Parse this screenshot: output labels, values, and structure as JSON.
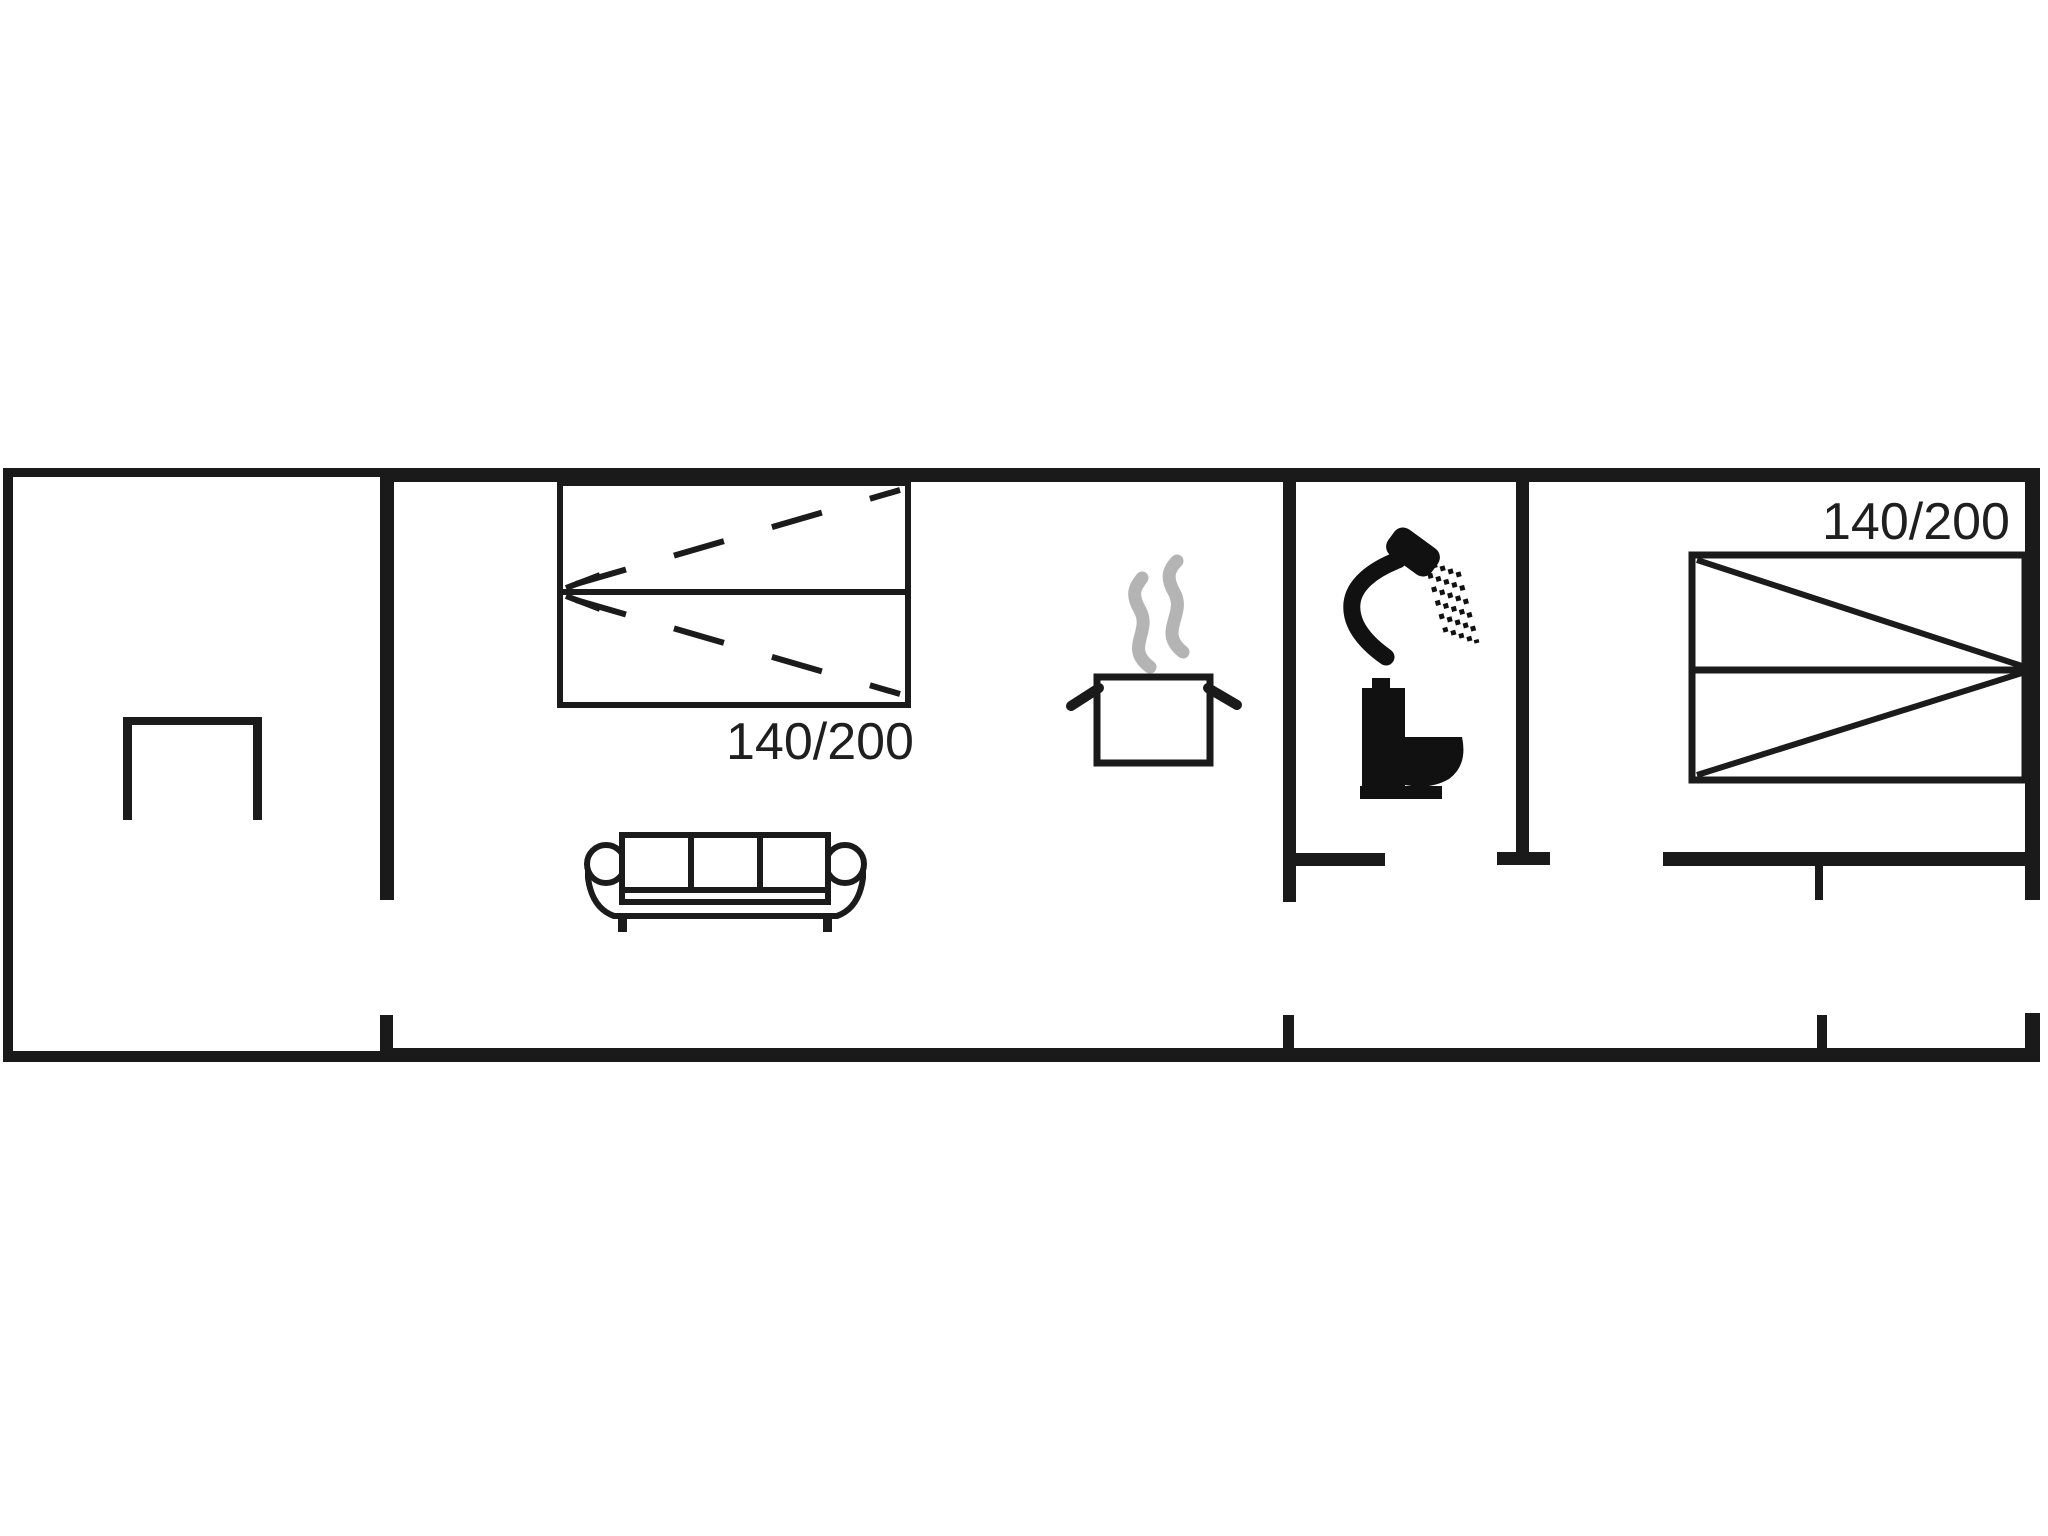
{
  "labels": {
    "bed_left": "140/200",
    "bed_right": "140/200"
  },
  "colors": {
    "wall": "#1a1a1a",
    "furniture_line": "#1b1b1b",
    "steam": "#b4b4b4",
    "text": "#1f1f1f",
    "background": "#ffffff"
  },
  "icons": [
    {
      "name": "table-icon"
    },
    {
      "name": "double-bed-dashed-icon"
    },
    {
      "name": "sofa-icon"
    },
    {
      "name": "steam-icon"
    },
    {
      "name": "cooking-pot-icon"
    },
    {
      "name": "shower-icon"
    },
    {
      "name": "toilet-icon"
    },
    {
      "name": "double-bed-solid-icon"
    }
  ]
}
